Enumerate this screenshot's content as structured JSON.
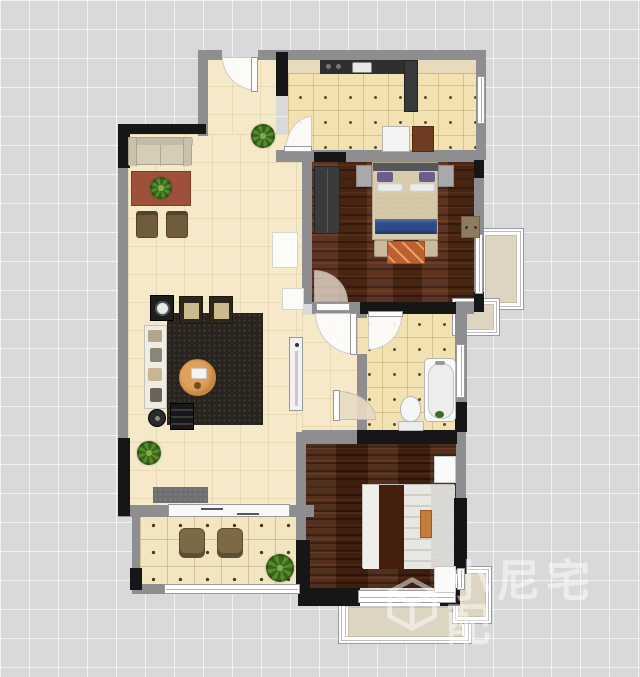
{
  "canvas": {
    "width": 640,
    "height": 677,
    "grid_px": 29,
    "background": "#d8d9da"
  },
  "watermark": {
    "logo": "cube-logo",
    "text": "小尼宅配",
    "color": "rgba(255,255,255,0.5)"
  },
  "colors": {
    "wall_gray": "#8e8e90",
    "wall_black": "#161616",
    "floor_living_cream": "#f6e9c9",
    "floor_kitchen_bath_yellow": "#f2e2b2",
    "floor_balcony": "#f2e6c0",
    "floor_bedroom1_wood": "#542a16",
    "floor_bedroom2_wood": "#4a2412",
    "bay_window_fill": "#ddd5c2",
    "bed1_blanket_blue": "#2d4a8a",
    "bed1_rug_orange": "#bd5f2e",
    "dining_table_orange": "#e0a25b",
    "coffee_table_red": "#9e5138"
  },
  "rooms": [
    {
      "name": "living-dining-room",
      "floor": "cream-tile"
    },
    {
      "name": "entry-hall",
      "floor": "cream-tile"
    },
    {
      "name": "kitchen",
      "floor": "yellow-tile"
    },
    {
      "name": "master-bedroom",
      "floor": "dark-wood"
    },
    {
      "name": "bathroom",
      "floor": "yellow-tile"
    },
    {
      "name": "second-bedroom",
      "floor": "dark-wood"
    },
    {
      "name": "balcony",
      "floor": "balcony-tile"
    }
  ],
  "furniture": [
    "sofa",
    "coffee-table",
    "stools",
    "dining-rug",
    "dining-chairs",
    "round-dining-table",
    "display-shelf",
    "floor-lamp",
    "piano-cabinet",
    "radiator",
    "doormat",
    "kitchen-counter",
    "sink",
    "fridge",
    "washing-machine",
    "wardrobe",
    "double-bed-1",
    "nightstands",
    "bench",
    "bedside-rug",
    "dresser",
    "bathtub",
    "toilet",
    "double-bed-2",
    "bed-tray",
    "white-nightstands",
    "wicker-chairs",
    "potted-plants"
  ]
}
